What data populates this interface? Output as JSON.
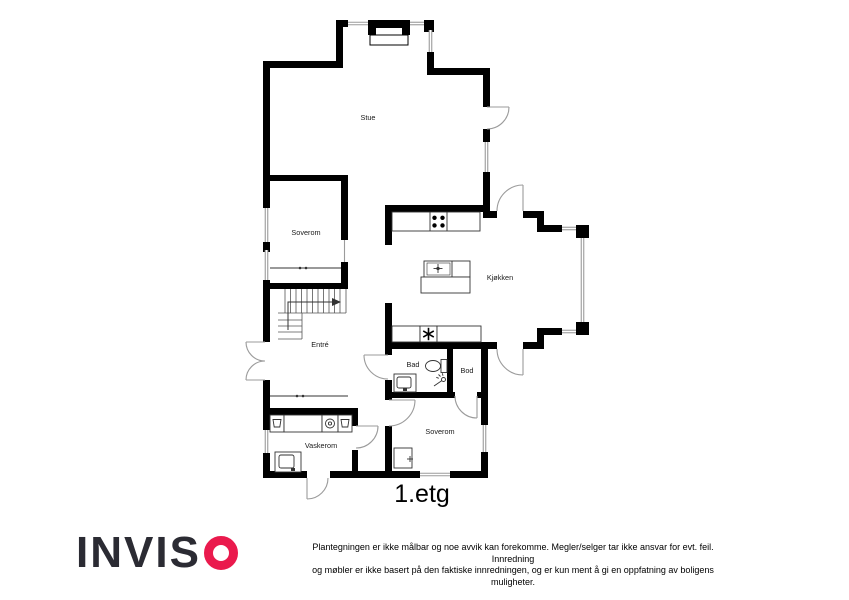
{
  "plan": {
    "floor_label": "1.etg",
    "rooms": {
      "stue": "Stue",
      "soverom_1": "Soverom",
      "kjokken": "Kjøkken",
      "entre": "Entré",
      "bad": "Bad",
      "bod": "Bod",
      "soverom_2": "Soverom",
      "vaskerom": "Vaskerom"
    },
    "fixtures": [
      "fireplace-icon",
      "stove-icon",
      "kitchen-island",
      "island-sink-icon",
      "water-heater-icon",
      "toilet-icon",
      "shower-icon",
      "bathroom-sink-icon",
      "laundry-counter",
      "washing-machine-icon",
      "laundry-basket-icon",
      "laundry-sink-icon",
      "bedroom-closet",
      "stairs-icon",
      "wardrobe-sliding-doors"
    ]
  },
  "footer": {
    "logo_text": "INVIS",
    "logo_o": "O",
    "disclaimer_line1": "Plantegningen er ikke målbar og noe avvik kan forekomme. Megler/selger tar ikke ansvar for evt. feil. Innredning",
    "disclaimer_line2": "og møbler er ikke basert på den faktiske innredningen, og er kun ment å gi en oppfatning av boligens muligheter."
  },
  "colors": {
    "wall": "#000000",
    "window": "#9b9b9b",
    "door": "#9b9b9b",
    "logo_dark": "#2b2b33",
    "logo_red": "#ea1a4d",
    "label": "#1a1a1a"
  }
}
